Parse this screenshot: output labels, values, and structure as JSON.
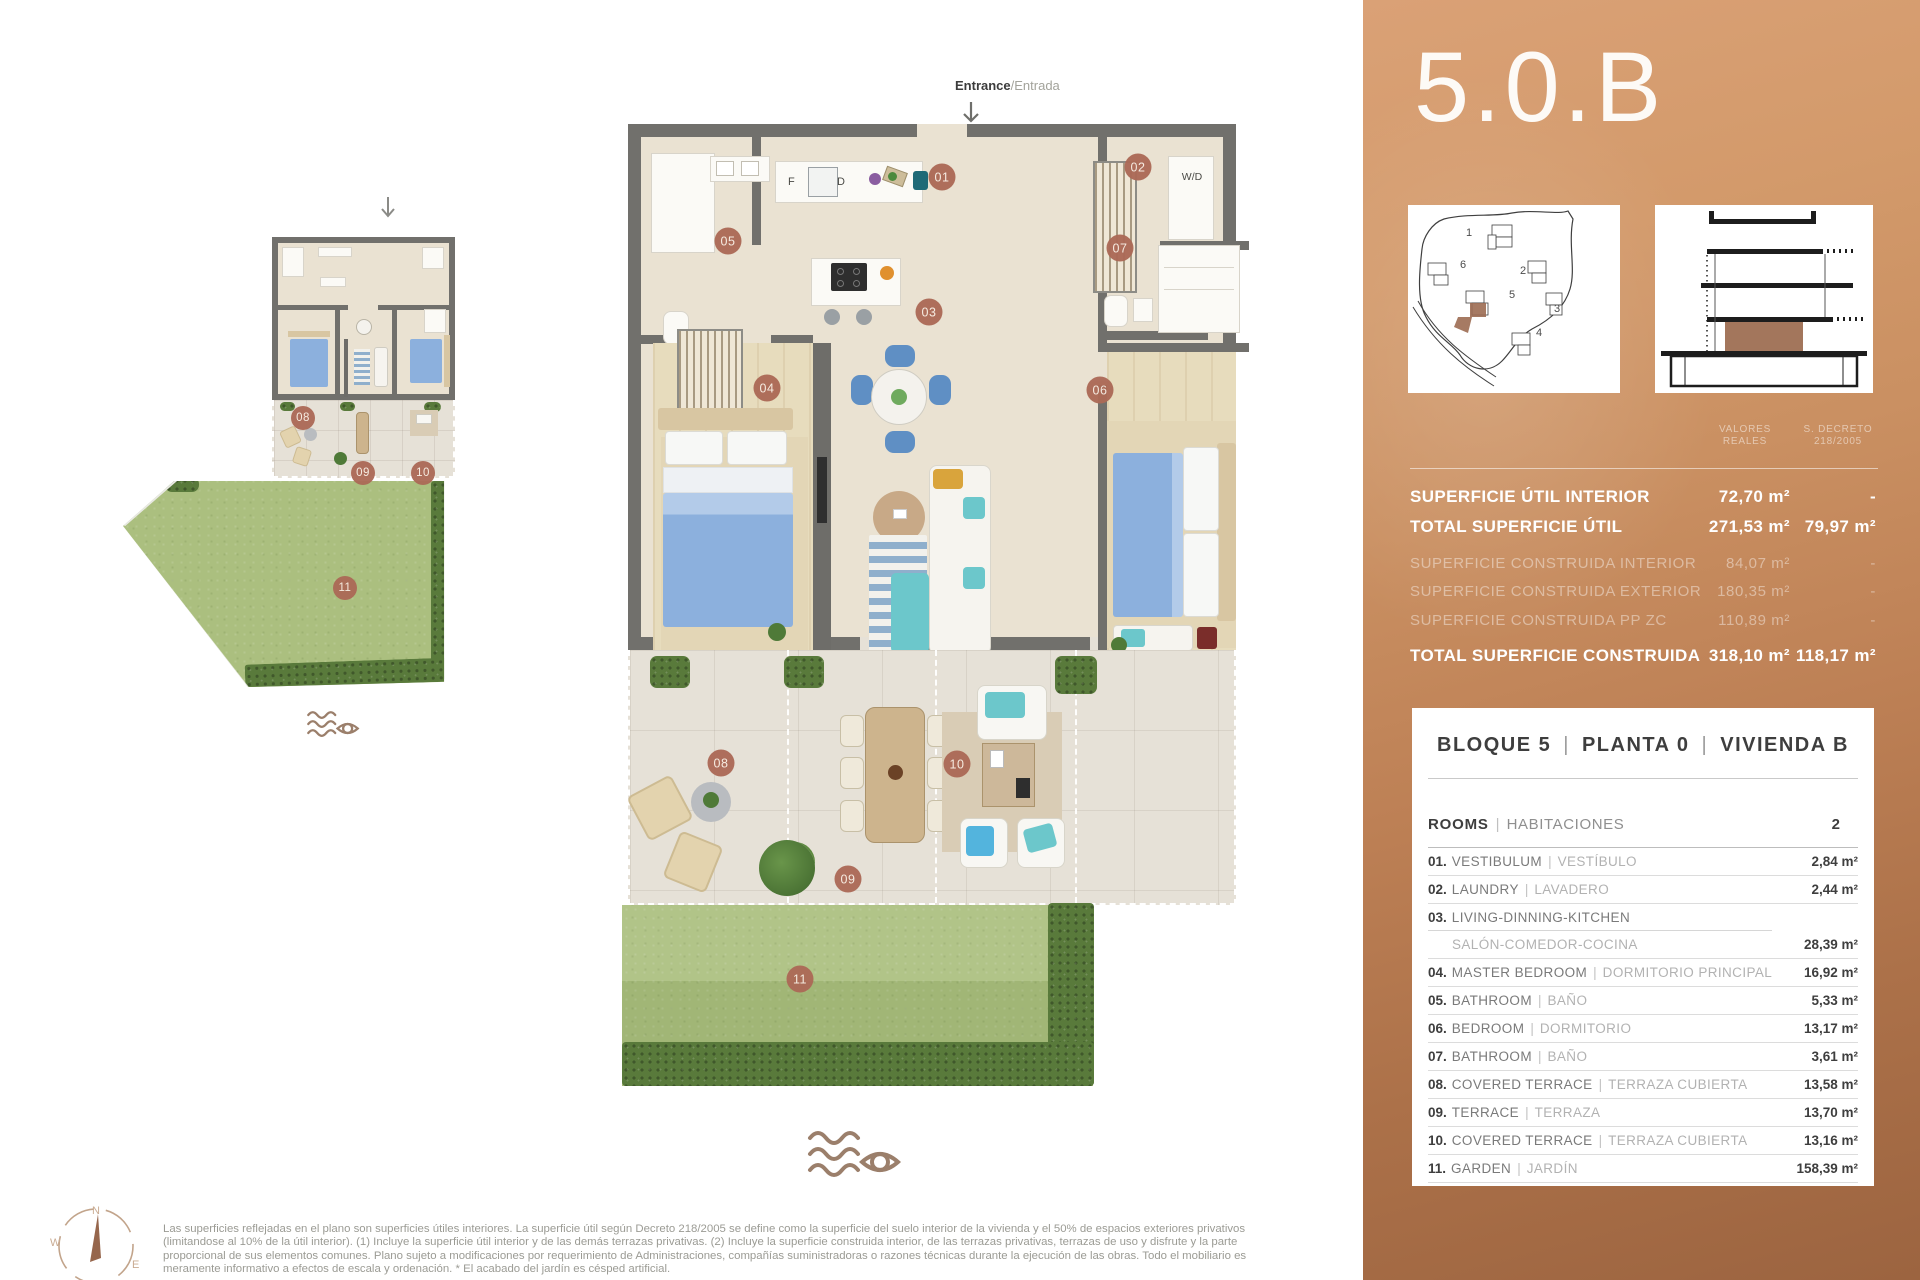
{
  "unit": {
    "title": "5.0.B"
  },
  "entrance": {
    "bold": "Entrance",
    "light": "/Entrada"
  },
  "plan_labels": {
    "wd": "W/D",
    "fridge": "F",
    "dishwasher": "D"
  },
  "site_plan": {
    "labels": [
      "1",
      "2",
      "3",
      "4",
      "5",
      "6"
    ]
  },
  "compass": {
    "n": "N",
    "e": "E",
    "s": "S",
    "w": "W"
  },
  "areas_table": {
    "col_headers": [
      [
        "VALORES",
        "REALES"
      ],
      [
        "S. DECRETO",
        "218/2005"
      ]
    ],
    "rows": [
      {
        "label": "SUPERFICIE ÚTIL INTERIOR",
        "v1": "72,70 m²",
        "v2": "-",
        "emphasis": true
      },
      {
        "label": "TOTAL SUPERFICIE ÚTIL",
        "v1": "271,53 m²",
        "v2": "79,97 m²",
        "emphasis": true
      },
      {
        "label": "SUPERFICIE CONSTRUIDA INTERIOR",
        "v1": "84,07 m²",
        "v2": "-",
        "emphasis": false
      },
      {
        "label": "SUPERFICIE CONSTRUIDA EXTERIOR",
        "v1": "180,35 m²",
        "v2": "-",
        "emphasis": false
      },
      {
        "label": "SUPERFICIE CONSTRUIDA PP ZC",
        "v1": "110,89 m²",
        "v2": "-",
        "emphasis": false
      },
      {
        "label": "TOTAL SUPERFICIE CONSTRUIDA",
        "v1": "318,10 m²",
        "v2": "118,17 m²",
        "emphasis": true
      }
    ]
  },
  "unit_card": {
    "header": {
      "bloque": "BLOQUE 5",
      "planta": "PLANTA 0",
      "vivienda": "VIVIENDA B",
      "sep": "|"
    },
    "rooms_header": {
      "en": "ROOMS",
      "es": "HABITACIONES",
      "sep": "|",
      "count": "2"
    },
    "rooms": [
      {
        "num": "01.",
        "en": "VESTIBULUM",
        "es": "VESTÍBULO",
        "area": "2,84 m²"
      },
      {
        "num": "02.",
        "en": "LAUNDRY",
        "es": "LAVADERO",
        "area": "2,44 m²"
      },
      {
        "num": "03.",
        "en": "LIVING-DINNING-KITCHEN",
        "es": "SALÓN-COMEDOR-COCINA",
        "area": "28,39 m²"
      },
      {
        "num": "04.",
        "en": "MASTER BEDROOM",
        "es": "DORMITORIO PRINCIPAL",
        "area": "16,92 m²"
      },
      {
        "num": "05.",
        "en": "BATHROOM",
        "es": "BAÑO",
        "area": "5,33 m²"
      },
      {
        "num": "06.",
        "en": "BEDROOM",
        "es": "DORMITORIO",
        "area": "13,17 m²"
      },
      {
        "num": "07.",
        "en": "BATHROOM",
        "es": "BAÑO",
        "area": "3,61 m²"
      },
      {
        "num": "08.",
        "en": "COVERED TERRACE",
        "es": "TERRAZA CUBIERTA",
        "area": "13,58 m²"
      },
      {
        "num": "09.",
        "en": "TERRACE",
        "es": "TERRAZA",
        "area": "13,70 m²"
      },
      {
        "num": "10.",
        "en": "COVERED TERRACE",
        "es": "TERRAZA CUBIERTA",
        "area": "13,16 m²"
      },
      {
        "num": "11.",
        "en": "GARDEN",
        "es": "JARDÍN",
        "area": "158,39 m²"
      }
    ]
  },
  "floor_plan": {
    "markers": [
      {
        "label": "01",
        "x": 942,
        "y": 177,
        "mini": false
      },
      {
        "label": "02",
        "x": 1138,
        "y": 167,
        "mini": false
      },
      {
        "label": "03",
        "x": 929,
        "y": 312,
        "mini": false
      },
      {
        "label": "04",
        "x": 767,
        "y": 388,
        "mini": false
      },
      {
        "label": "05",
        "x": 728,
        "y": 241,
        "mini": false
      },
      {
        "label": "06",
        "x": 1100,
        "y": 390,
        "mini": false
      },
      {
        "label": "07",
        "x": 1120,
        "y": 248,
        "mini": false
      },
      {
        "label": "08",
        "x": 721,
        "y": 763,
        "mini": false
      },
      {
        "label": "09",
        "x": 848,
        "y": 879,
        "mini": false
      },
      {
        "label": "10",
        "x": 957,
        "y": 764,
        "mini": false
      },
      {
        "label": "11",
        "x": 800,
        "y": 979,
        "mini": false
      },
      {
        "label": "08",
        "x": 303,
        "y": 418,
        "mini": true
      },
      {
        "label": "09",
        "x": 363,
        "y": 473,
        "mini": true
      },
      {
        "label": "10",
        "x": 423,
        "y": 473,
        "mini": true
      },
      {
        "label": "11",
        "x": 345,
        "y": 588,
        "mini": true
      }
    ]
  },
  "disclaimer_lines": [
    "Las superficies reflejadas en el plano son superficies útiles interiores. La superficie útil según Decreto 218/2005 se define como la superficie del suelo interior de la vivienda y el 50% de espacios exteriores privativos",
    "(limitandose al 10% de la útil interior). (1) Incluye la superficie útil interior y de las demás terrazas privativas. (2) Incluye la superficie construida interior, de las terrazas privativas, terrazas de uso y disfrute y la parte",
    "proporcional de sus elementos comunes. Plano sujeto a modificaciones por requerimiento de Administraciones, compañías suministradoras o razones técnicas durante la ejecución de las obras. Todo el mobiliario es",
    "meramente informativo a efectos de escala y ordenación. * El acabado del jardín es césped artificial."
  ],
  "colors": {
    "panel_copper_light": "#daa176",
    "panel_copper_dark": "#9c6440",
    "marker": "#ac6a57",
    "wall": "#71706c",
    "grass": "#abbf7f",
    "hedge": "#597a3b",
    "highlight_unit": "#9c6b52"
  }
}
